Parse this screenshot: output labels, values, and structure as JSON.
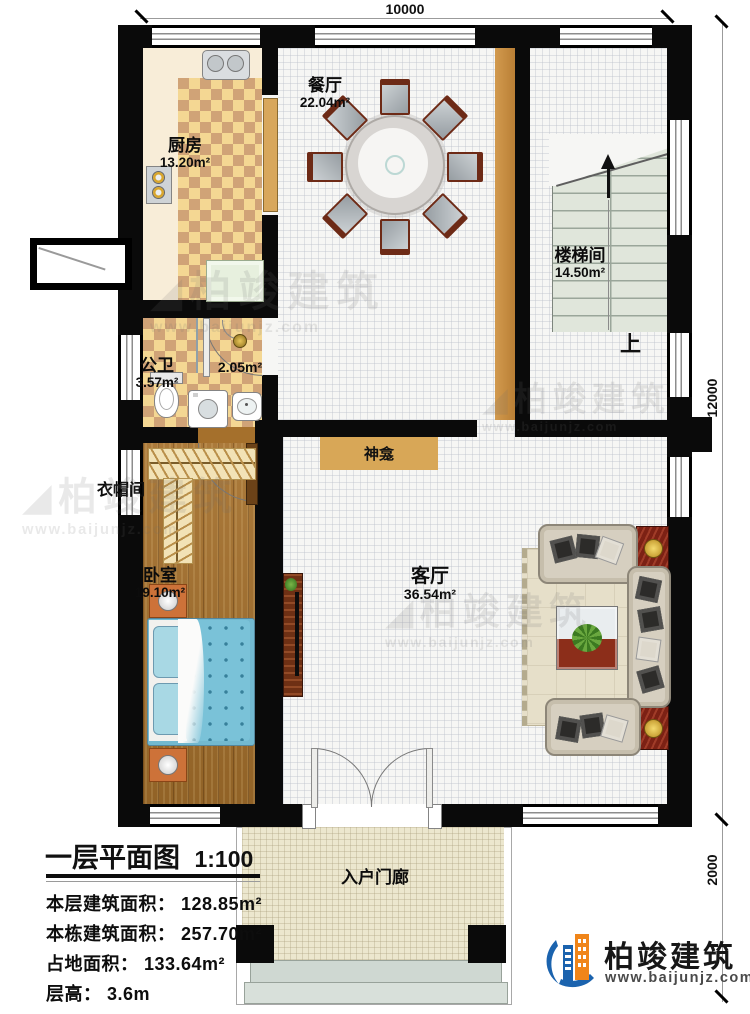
{
  "dims": {
    "width": "10000",
    "height": "12000",
    "porch_depth": "2000"
  },
  "rooms": {
    "kitchen": {
      "name": "厨房",
      "area": "13.20m²"
    },
    "dining": {
      "name": "餐厅",
      "area": "22.04m²"
    },
    "stairwell": {
      "name": "楼梯间",
      "area": "14.50m²"
    },
    "bathroom": {
      "name": "公卫",
      "area": "3.57m²"
    },
    "hallway": {
      "area": "2.05m²"
    },
    "cloakroom": {
      "name": "衣帽间"
    },
    "bedroom": {
      "name": "卧室",
      "area": "19.10m²"
    },
    "living": {
      "name": "客厅",
      "area": "36.54m²"
    },
    "shrine": {
      "name": "神龛"
    },
    "porch": {
      "name": "入户门廊"
    }
  },
  "stairs": {
    "up_label": "上"
  },
  "legend": {
    "title": "一层平面图",
    "scale": "1:100",
    "rows": [
      "本层建筑面积： 128.85m²",
      "本栋建筑面积： 257.70m²",
      "占地面积： 133.64m²",
      "层高： 3.6m"
    ]
  },
  "branding": {
    "company": "柏竣建筑",
    "website": "www.baijunjz.com"
  },
  "watermark": {
    "text": "柏竣建筑",
    "website": "www.baijunjz.com"
  },
  "colors": {
    "wall": "#0a0a0a",
    "wood_floor": "#a5702c",
    "tile_light": "#f4d793",
    "tile_dark": "#d0a377",
    "shrine_tan": "#d8a757",
    "stair_green": "#e0e6db",
    "porch_beige": "#ece7ce",
    "logo_blue": "#1b63ae",
    "logo_orange": "#f08519"
  }
}
